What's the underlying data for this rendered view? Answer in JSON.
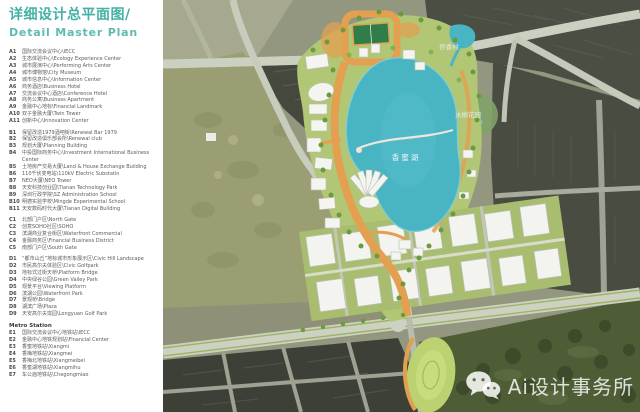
{
  "panel": {
    "title": "详细设计总平面图/",
    "subtitle": "Detail Master Plan",
    "sections": [
      {
        "key": "A",
        "items": [
          {
            "id": "A1",
            "label": "国际交流会议中心\\IECC"
          },
          {
            "id": "A2",
            "label": "生态体验中心\\Ecology Experience Center"
          },
          {
            "id": "A3",
            "label": "城市展演中心\\Performing Arts Center"
          },
          {
            "id": "A4",
            "label": "城市博物馆\\City Museum"
          },
          {
            "id": "A5",
            "label": "城市信息中心\\Information Center"
          },
          {
            "id": "A6",
            "label": "商务酒店\\Business Hotel"
          },
          {
            "id": "A7",
            "label": "交流会议中心酒店\\Conference Hotel"
          },
          {
            "id": "A8",
            "label": "商务公寓\\Business Apartment"
          },
          {
            "id": "A9",
            "label": "金融中心地标\\Financial Landmark"
          },
          {
            "id": "A10",
            "label": "双子金融大厦\\Twin Tower"
          },
          {
            "id": "A11",
            "label": "创新中心\\Innovation Center"
          }
        ]
      },
      {
        "key": "B",
        "items": [
          {
            "id": "B1",
            "label": "保留改造1979酒吧街\\Renewal Bar 1979"
          },
          {
            "id": "B2",
            "label": "保留改造俱乐部会所\\Renewal club"
          },
          {
            "id": "B3",
            "label": "规划大厦\\Planning Building"
          },
          {
            "id": "B4",
            "label": "中投国际商务中心\\Investment International Business Center"
          },
          {
            "id": "B5",
            "label": "土地房产交易大厦\\Land & House Exchange Building"
          },
          {
            "id": "B6",
            "label": "110千伏变电站\\110kV Electric Substatin"
          },
          {
            "id": "B7",
            "label": "NEO大厦\\NEO Tower"
          },
          {
            "id": "B8",
            "label": "天安科技创业园\\Tianan Technology Park"
          },
          {
            "id": "B9",
            "label": "深圳行政学院\\SZ Administration School"
          },
          {
            "id": "B10",
            "label": "明德实验学校\\Mingde Experimental School"
          },
          {
            "id": "B11",
            "label": "天安数码时代大厦\\Tianan Digital Building"
          }
        ]
      },
      {
        "key": "C",
        "items": [
          {
            "id": "C1",
            "label": "北部门户区\\North Gate"
          },
          {
            "id": "C2",
            "label": "创意SOHO社区\\SOHO"
          },
          {
            "id": "C3",
            "label": "滨湖商业复合街区\\Waterfront Commercial"
          },
          {
            "id": "C4",
            "label": "金融商务区\\Financial Business District"
          },
          {
            "id": "C5",
            "label": "南部门户区\\South Gate"
          }
        ]
      },
      {
        "key": "D",
        "items": [
          {
            "id": "D1",
            "label": "“都市山丘”地标城市形象展示区\\Civic Hill Landscape"
          },
          {
            "id": "D2",
            "label": "市民高尔夫体验区\\Civic Golfpark"
          },
          {
            "id": "D3",
            "label": "地标式过街天桥\\Platform Bridge"
          },
          {
            "id": "D4",
            "label": "中央绿谷公园\\Green Valley Park"
          },
          {
            "id": "D5",
            "label": "观景平台\\Viewing Platform"
          },
          {
            "id": "D6",
            "label": "滨湖公园\\Waterfront Park"
          },
          {
            "id": "D7",
            "label": "景观桥\\Bridge"
          },
          {
            "id": "D8",
            "label": "湖滨广场\\Plaza"
          },
          {
            "id": "D9",
            "label": "天安高尔夫珑园\\Longyuan Golf Park"
          }
        ]
      },
      {
        "key": "E",
        "header": "Metro Station",
        "items": [
          {
            "id": "E1",
            "label": "国际交流会议中心地铁站\\IECC"
          },
          {
            "id": "E2",
            "label": "金融中心地铁规划站\\Financial Center"
          },
          {
            "id": "E3",
            "label": "香蜜地铁站\\Xiangmi"
          },
          {
            "id": "E4",
            "label": "香梅地铁站\\Xiangmei"
          },
          {
            "id": "E5",
            "label": "香梅北地铁站\\Xiangmeibei"
          },
          {
            "id": "E6",
            "label": "香蜜湖地铁站\\Xiangmihu"
          },
          {
            "id": "E7",
            "label": "车公庙地铁站\\Chegongmiao"
          }
        ]
      }
    ]
  },
  "map": {
    "labels": {
      "lake": "香蜜湖",
      "village": "侨香村",
      "garden": "水榭花园"
    },
    "watermark": {
      "text": "Ai设计事务所",
      "icon": "wechat-icon"
    },
    "colors": {
      "accent_teal": "#45b1a5",
      "lake_blue": "#49b4c2",
      "plan_orange": "#e2a050",
      "park_green": "#b2c776",
      "tree_green": "#6d9a3e",
      "road_gray": "#ccd0c1",
      "dark_urban": "#45483d",
      "golf_khaki": "#9b9e72",
      "golf_dark": "#4f5d37",
      "sports_field_green": "#2f7d49"
    }
  }
}
